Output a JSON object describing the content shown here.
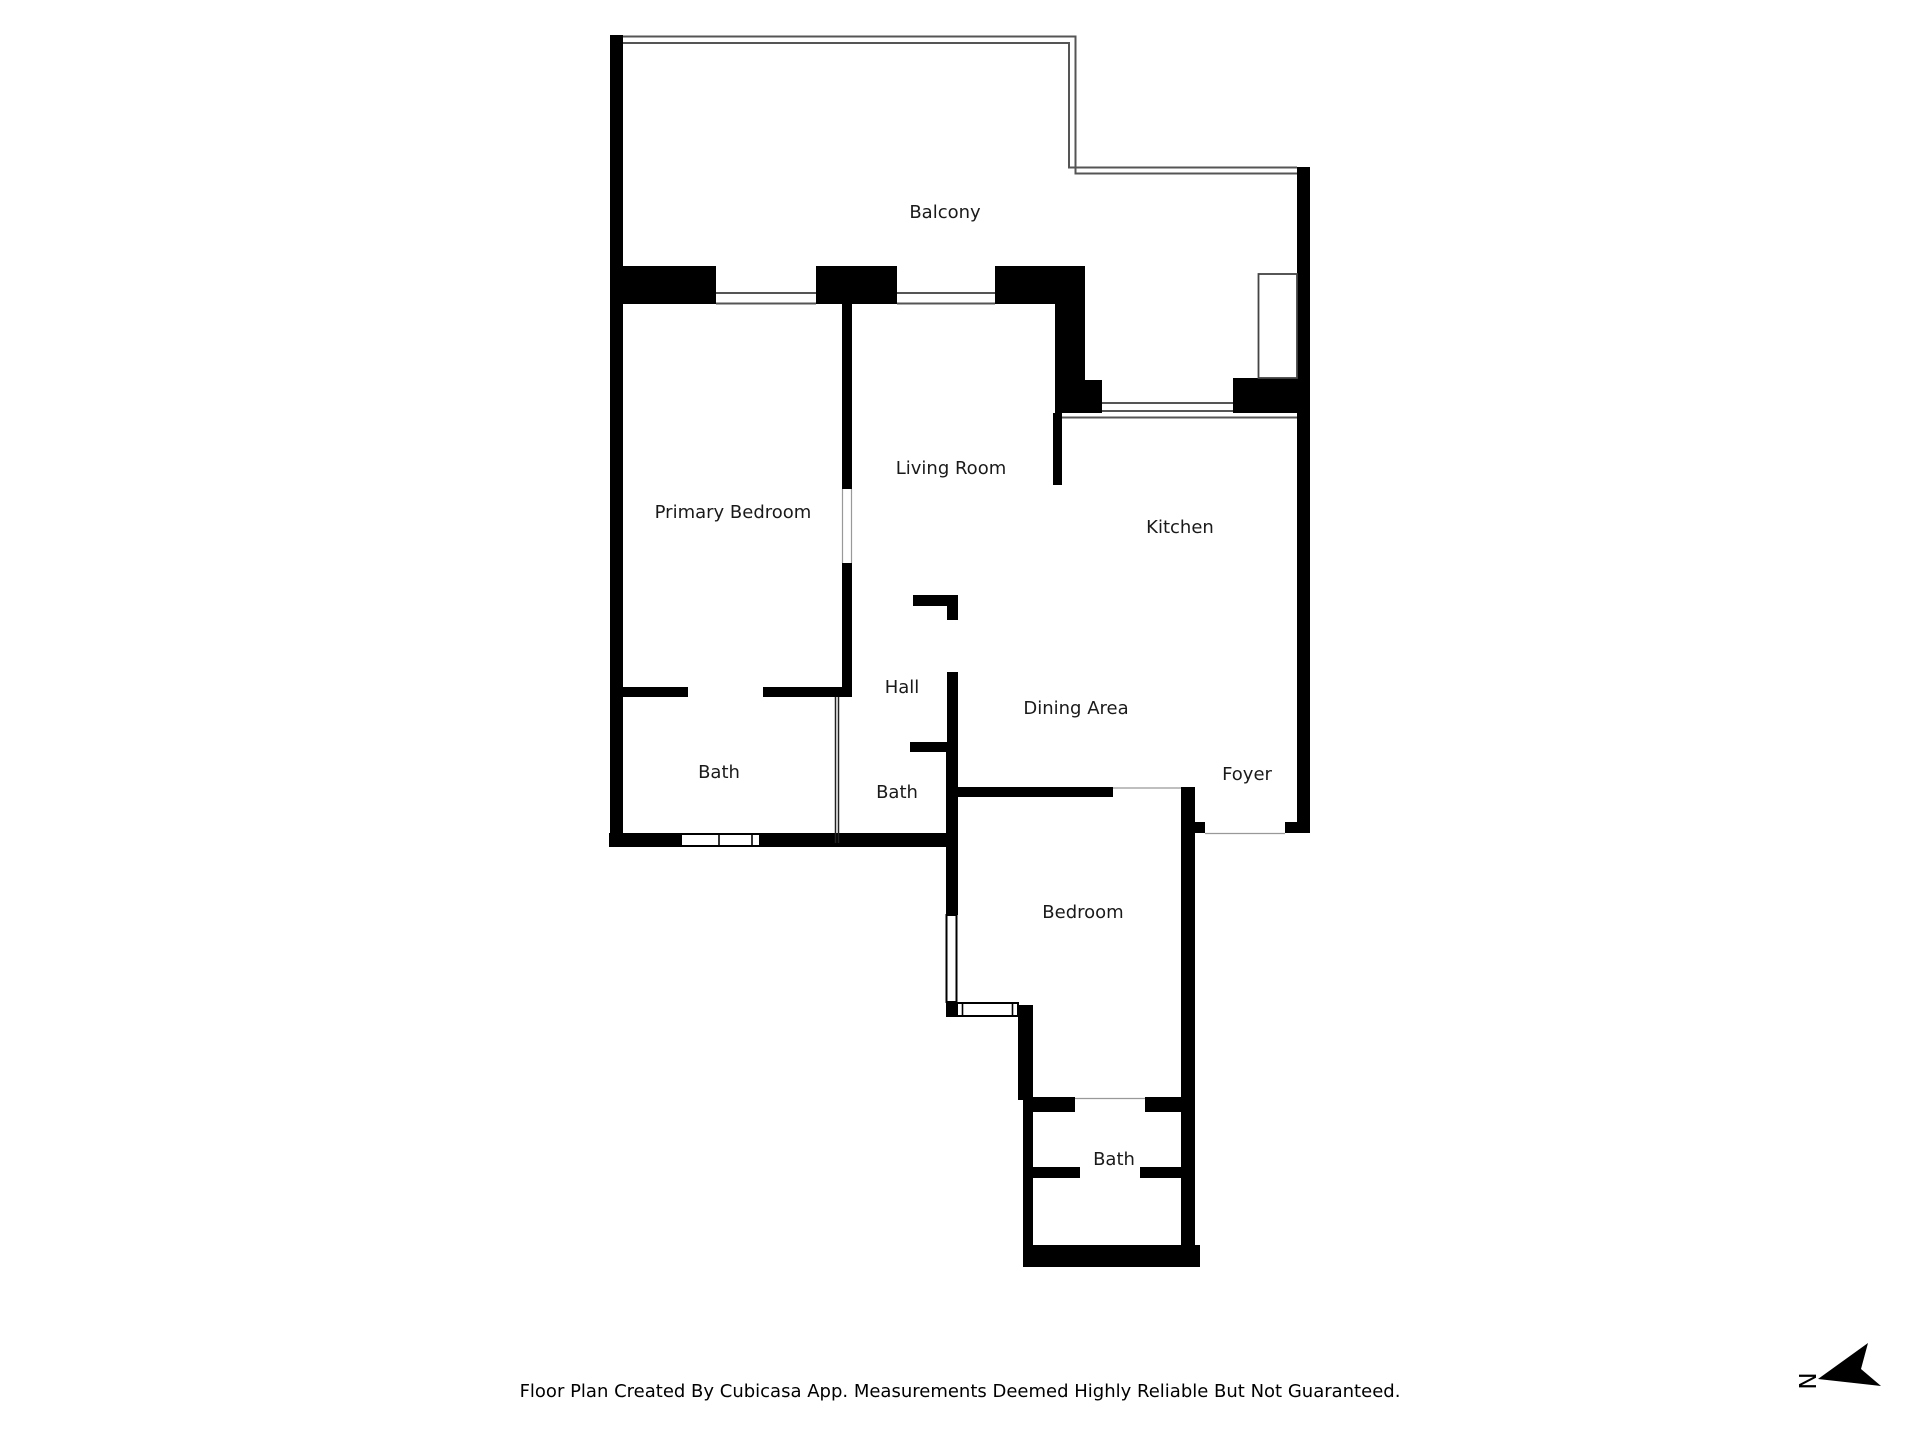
{
  "floor_plan": {
    "rooms": [
      {
        "name": "Balcony"
      },
      {
        "name": "Primary Bedroom"
      },
      {
        "name": "Living Room"
      },
      {
        "name": "Kitchen"
      },
      {
        "name": "Hall"
      },
      {
        "name": "Dining Area"
      },
      {
        "name": "Foyer"
      },
      {
        "name": "Bath"
      },
      {
        "name": "Bath"
      },
      {
        "name": "Bedroom"
      },
      {
        "name": "Bath"
      }
    ],
    "compass": {
      "letter": "N"
    },
    "footer_text": "Floor Plan Created By Cubicasa App. Measurements Deemed Highly Reliable But Not Guaranteed.",
    "colors": {
      "wall": "#000000",
      "window_line": "#555555",
      "label_text": "#1a1a1a",
      "background": "#ffffff"
    }
  }
}
